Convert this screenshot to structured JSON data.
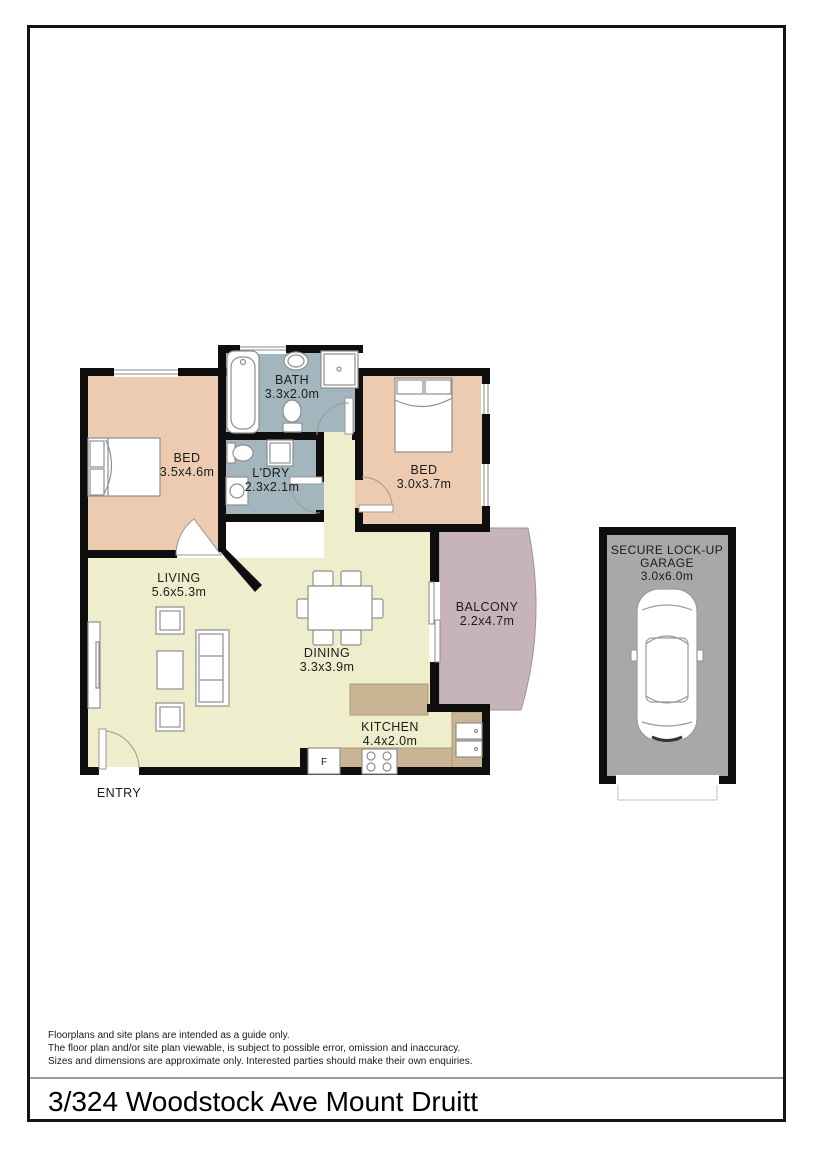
{
  "page": {
    "background": "#ffffff",
    "frame_color": "#141414",
    "divider_color": "#9a9a9a"
  },
  "floorplan": {
    "wall_color": "#0e0e0e",
    "furniture_stroke": "#8f8f8f",
    "door_stroke": "#9a9a9a",
    "counter_color": "#c9b493",
    "counter_edge": "#ab9a76",
    "fridge_label": "F",
    "rooms": [
      {
        "id": "bath",
        "label": "BATH",
        "dims": "3.3x2.0m",
        "color": "#a3b6bd"
      },
      {
        "id": "bed-1",
        "label": "BED",
        "dims": "3.5x4.6m",
        "color": "#eccbb0"
      },
      {
        "id": "laundry",
        "label": "L'DRY",
        "dims": "2.3x2.1m",
        "color": "#a3b6bd"
      },
      {
        "id": "bed-2",
        "label": "BED",
        "dims": "3.0x3.7m",
        "color": "#eccbb0"
      },
      {
        "id": "living",
        "label": "LIVING",
        "dims": "5.6x5.3m",
        "color": "#eeeecd"
      },
      {
        "id": "dining",
        "label": "DINING",
        "dims": "3.3x3.9m",
        "color": "#eeeecd"
      },
      {
        "id": "balcony",
        "label": "BALCONY",
        "dims": "2.2x4.7m",
        "color": "#c7b4b9"
      },
      {
        "id": "kitchen",
        "label": "KITCHEN",
        "dims": "4.4x2.0m",
        "color": "#eeeecd"
      },
      {
        "id": "entry",
        "label": "ENTRY",
        "dims": ""
      }
    ],
    "garage": {
      "line1": "SECURE LOCK-UP",
      "line2": "GARAGE",
      "dims": "3.0x6.0m",
      "floor_color": "#a8a8a8"
    }
  },
  "disclaimer": {
    "line1": "Floorplans and site plans are intended as a guide only.",
    "line2": "The floor plan and/or site plan viewable, is subject to possible error, omission and inaccuracy.",
    "line3": "Sizes and dimensions are approximate only. Interested parties should make their own enquiries."
  },
  "address": "3/324 Woodstock Ave Mount Druitt"
}
